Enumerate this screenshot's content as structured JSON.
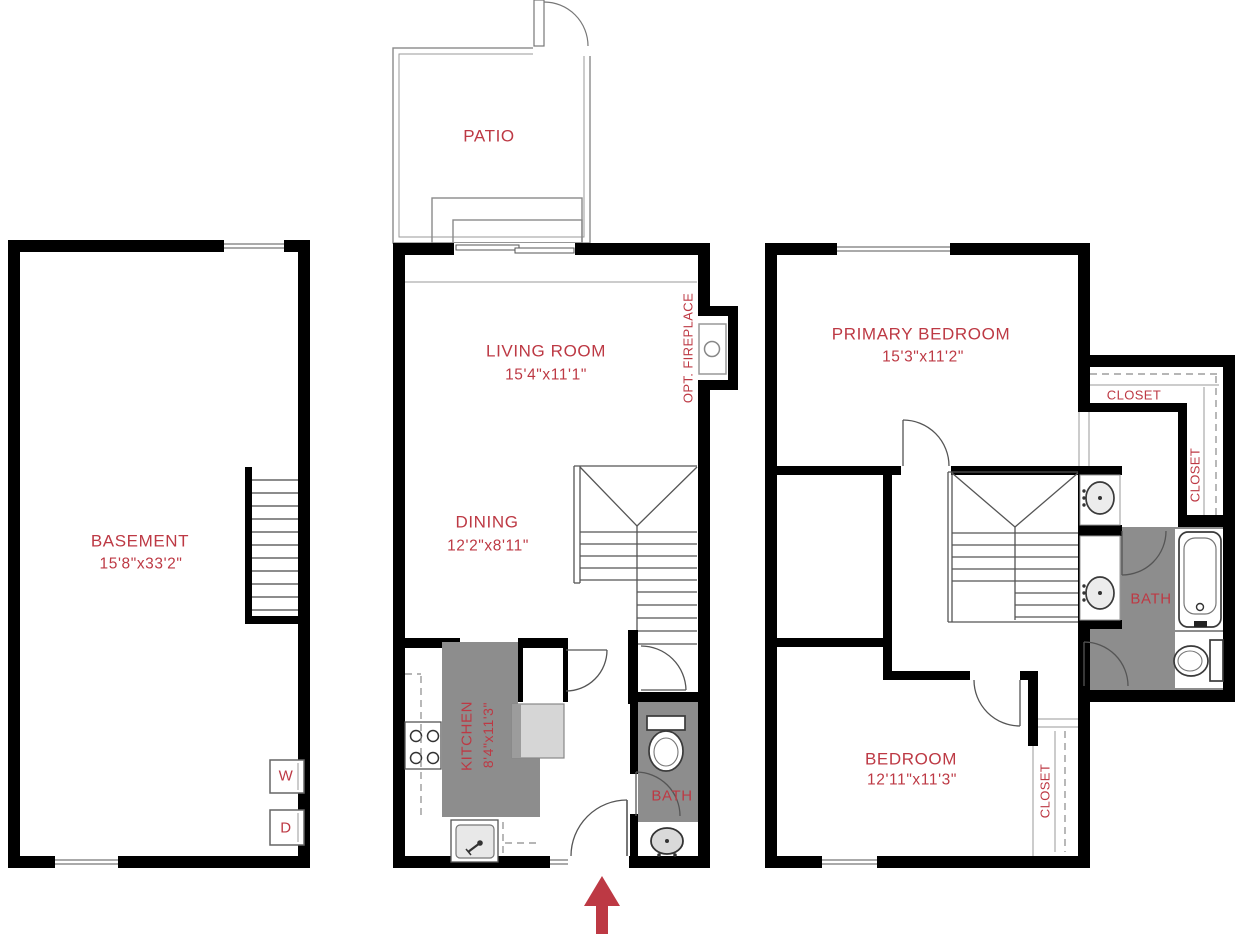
{
  "colors": {
    "label": "#bd3944",
    "wall": "#000000",
    "floor_gray": "#8d8d8d"
  },
  "floors": {
    "basement": {
      "room": {
        "name": "BASEMENT",
        "dims": "15'8\"x33'2\""
      },
      "washer_label": "W",
      "dryer_label": "D"
    },
    "main": {
      "patio_label": "PATIO",
      "living_room": {
        "name": "LIVING ROOM",
        "dims": "15'4\"x11'1\""
      },
      "dining": {
        "name": "DINING",
        "dims": "12'2\"x8'11\""
      },
      "kitchen": {
        "name": "KITCHEN",
        "dims": "8'4\"x11'3\""
      },
      "fireplace_label": "OPT. FIREPLACE",
      "bath_label": "BATH"
    },
    "upper": {
      "primary_bedroom": {
        "name": "PRIMARY BEDROOM",
        "dims": "15'3\"x11'2\""
      },
      "bedroom": {
        "name": "BEDROOM",
        "dims": "12'11\"x11'3\""
      },
      "bath_label": "BATH",
      "primary_closet_label": "CLOSET",
      "primary_closet_side_label": "CLOSET",
      "bedroom_closet_label": "CLOSET"
    }
  }
}
